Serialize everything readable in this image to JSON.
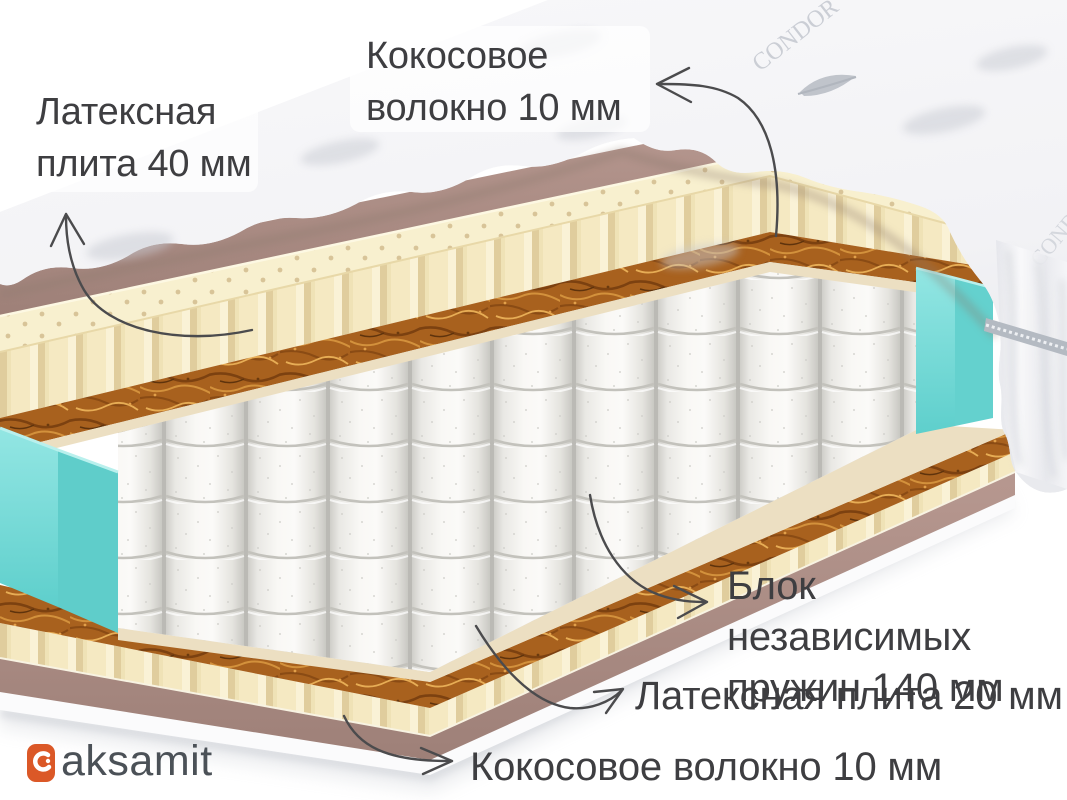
{
  "page": {
    "background": "#ffffff"
  },
  "annotations": {
    "latex_top": {
      "line1": "Латексная",
      "line2": "плита 40 мм"
    },
    "coconut_top": {
      "line1": "Кокосовое",
      "line2": "волокно 10 мм"
    },
    "spring_block": {
      "line1": "Блок независимых",
      "line2": "пружин 140 мм"
    },
    "latex_bottom": {
      "text": "Латексная плита 20 мм"
    },
    "coconut_bottom": {
      "text": "Кокосовое волокно 10 мм"
    }
  },
  "logo": {
    "text": "aksamit",
    "icon_color": "#db5827",
    "text_color": "#4b5157"
  },
  "cover": {
    "embroidery": "CONDOR"
  },
  "mattress_layers": [
    {
      "name": "quilted-cover",
      "color": "#f5f5f8"
    },
    {
      "name": "cover-underside",
      "color": "#b09088"
    },
    {
      "name": "latex-plate-40mm",
      "color": "#f5e9c2"
    },
    {
      "name": "coconut-fiber-10mm",
      "color": "#a8611e"
    },
    {
      "name": "felt-pad",
      "color": "#ecdfc2"
    },
    {
      "name": "independent-springs-140mm",
      "color": "#f3f2ef"
    },
    {
      "name": "side-foam",
      "color": "#74d6d4"
    },
    {
      "name": "coconut-fiber-10mm-bottom",
      "color": "#a8611e"
    },
    {
      "name": "latex-plate-20mm",
      "color": "#f3ead0"
    },
    {
      "name": "base-cover",
      "color": "#b09088"
    }
  ],
  "style": {
    "label_text": "#3e3e41",
    "arrow": "#4b4b4d"
  }
}
